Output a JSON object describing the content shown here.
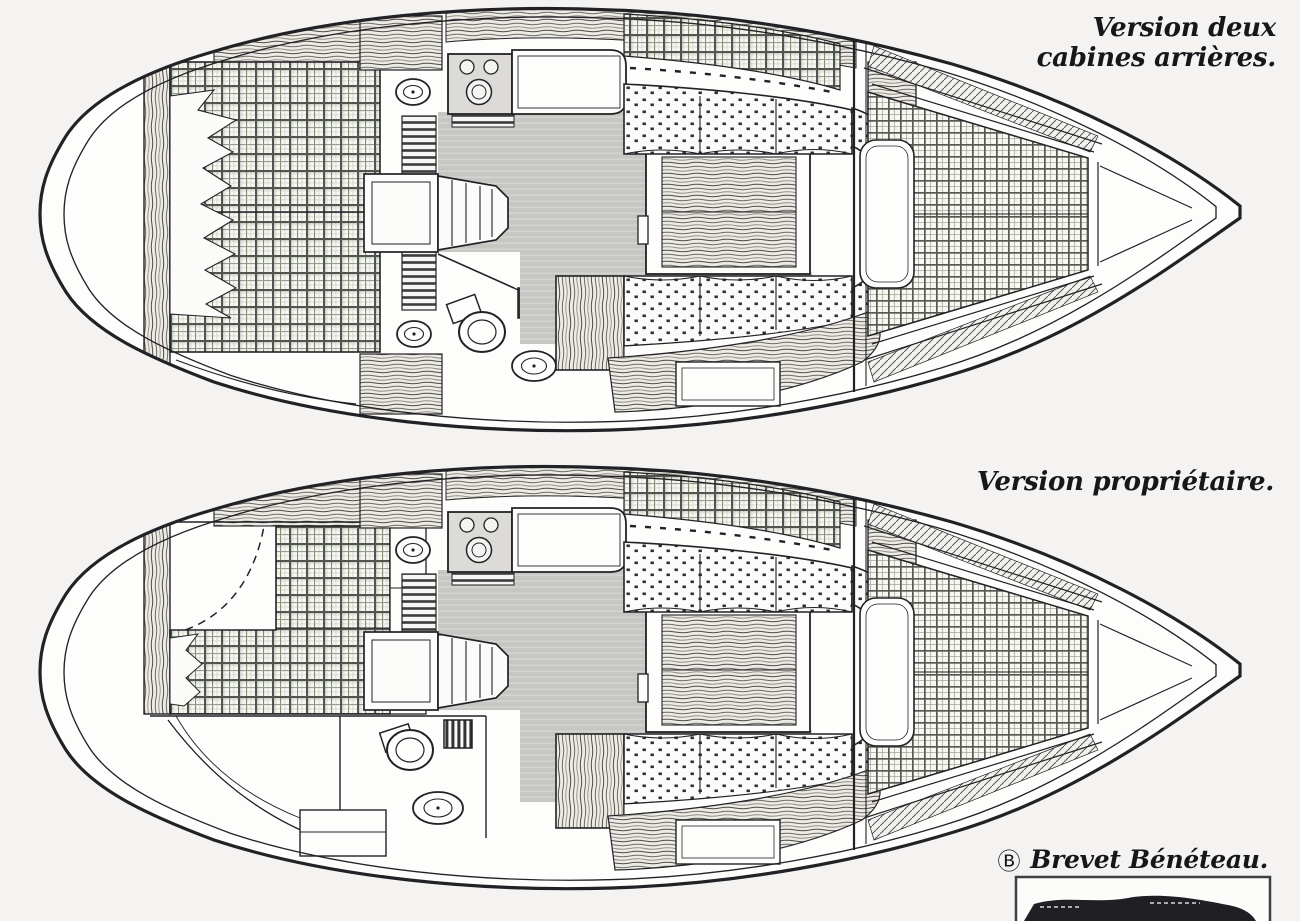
{
  "page": {
    "background": "#f5f3f2",
    "ink": "#222226",
    "paper_white": "#fdfdfc",
    "floor_gray": "#c6c6c3"
  },
  "captions": {
    "top_version": "Version deux\ncabines arrières.",
    "bottom_version": "Version propriétaire."
  },
  "footer": {
    "symbol": "Ⓑ",
    "text": "Brevet Bénéteau."
  }
}
